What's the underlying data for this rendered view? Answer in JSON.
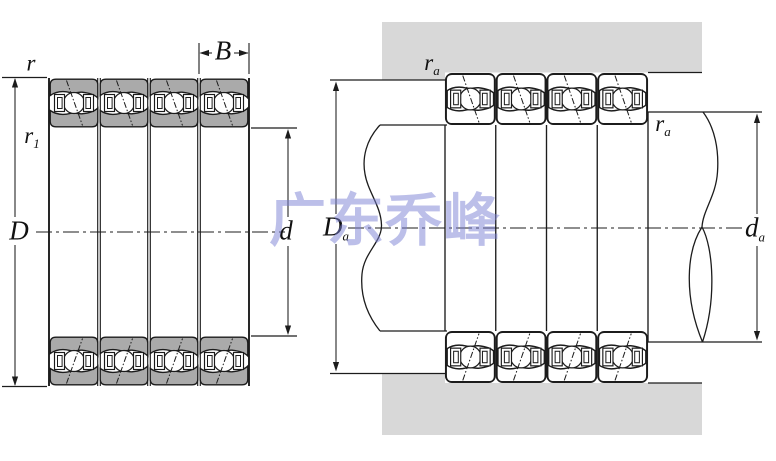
{
  "title": "quad bearing arrangement drawing",
  "watermark": {
    "text": "广东乔峰",
    "color": "#7b81d4"
  },
  "colors": {
    "background": "#ffffff",
    "line": "#1c1c1c",
    "ring_gray": "#aaaaaa",
    "housing_gray": "#d8d8d8",
    "bearing_white": "#ffffff"
  },
  "left_view": {
    "labels": {
      "r": {
        "main": "r"
      },
      "r1": {
        "main": "r",
        "sub": "1"
      },
      "B": {
        "main": "B"
      },
      "D": {
        "main": "D"
      },
      "d": {
        "main": "d"
      }
    }
  },
  "right_view": {
    "labels": {
      "ra_left": {
        "main": "r",
        "sub": "a"
      },
      "ra_right": {
        "main": "r",
        "sub": "a"
      },
      "Da": {
        "main": "D",
        "sub": "a"
      },
      "da": {
        "main": "d",
        "sub": "a"
      }
    }
  }
}
